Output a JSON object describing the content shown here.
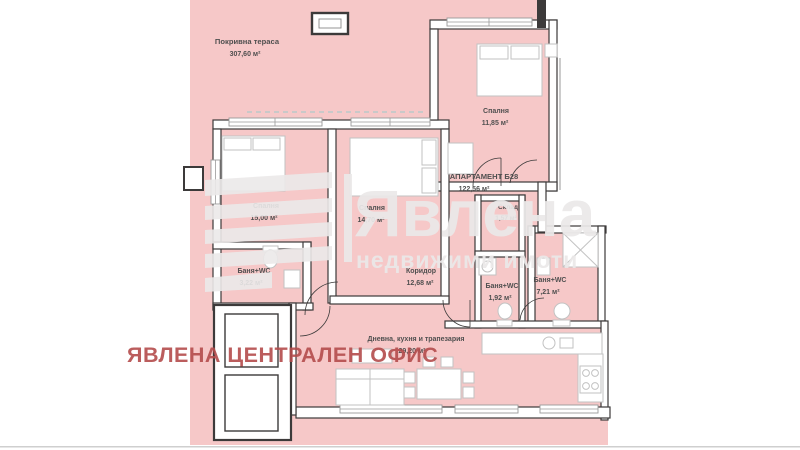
{
  "apartment": {
    "title": "АПАРТАМЕНТ Б28",
    "area": "122,56 м²"
  },
  "rooms": [
    {
      "name": "Покривна тераса",
      "area": "307,60 м²"
    },
    {
      "name": "Спалня",
      "area": "11,85 м²"
    },
    {
      "name": "Спалня",
      "area": "15,00 м²"
    },
    {
      "name": "Спалня",
      "area": "14,70 м²"
    },
    {
      "name": "Склад",
      "area": "1,57 м²"
    },
    {
      "name": "Коридор",
      "area": "12,68 м²"
    },
    {
      "name": "Баня+WC",
      "area": "3,22 м²"
    },
    {
      "name": "Баня+WC",
      "area": "1,92 м²"
    },
    {
      "name": "Баня+WC",
      "area": "7,21 м²"
    },
    {
      "name": "Дневна, кухня и трапезария",
      "area": "29,20 м²"
    }
  ],
  "watermark": {
    "brand": "Явлена",
    "tagline": "недвижими  имоти"
  },
  "stamp": "ЯВЛЕНА ЦЕНТРАЛЕН ОФИС",
  "colors": {
    "pink": "#f6c8c8",
    "wall": "#3c3a3a",
    "furn": "#c2c2c2",
    "label": "#4f4f4f",
    "watermark": "#ebe9e9",
    "stamp": "#b44c4c"
  }
}
